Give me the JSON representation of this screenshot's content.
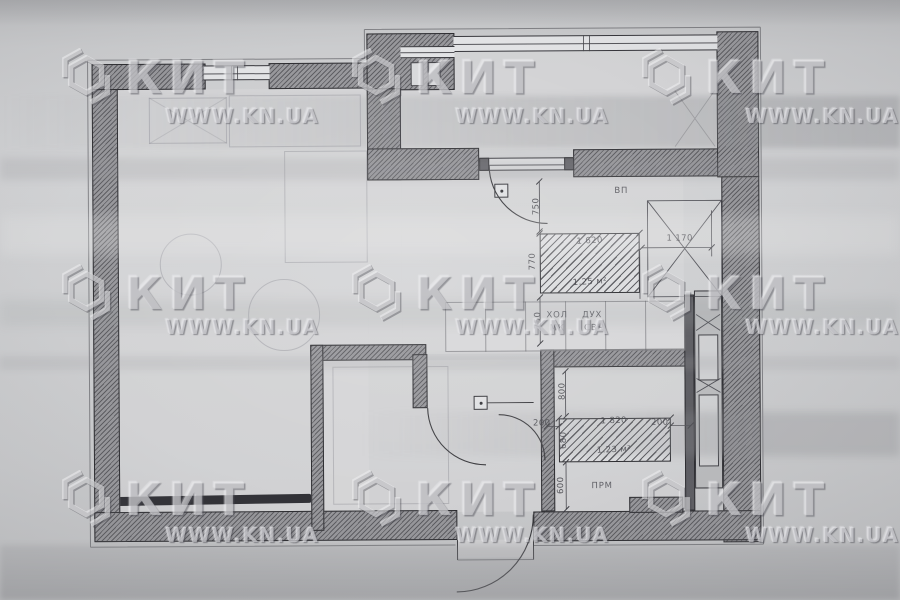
{
  "watermark": {
    "brand": "КИТ",
    "site": "WWW.KN.UA"
  },
  "plan": {
    "labels": {
      "vent": "ВП",
      "fridge": "ХОЛ",
      "sink": "МК",
      "oven": "ДУХ",
      "microwave": "СВЧ",
      "washer": "ПРМ"
    },
    "dims": {
      "v750_top": "750",
      "wardrobe_w": "1 620",
      "wardrobe_h": "770",
      "gap_right": "1 170",
      "wardrobe_area": "1.25 м²",
      "v750_mid": "750",
      "v800": "800",
      "tub_gap_left": "200",
      "tub_w": "1 820",
      "tub_gap_right": "200",
      "tub_h": "680",
      "tub_area": "1.23 м²",
      "v600": "600"
    }
  },
  "colors": {
    "paper": "#cbccce",
    "wall": "#97979b",
    "line": "#2c2c30"
  }
}
